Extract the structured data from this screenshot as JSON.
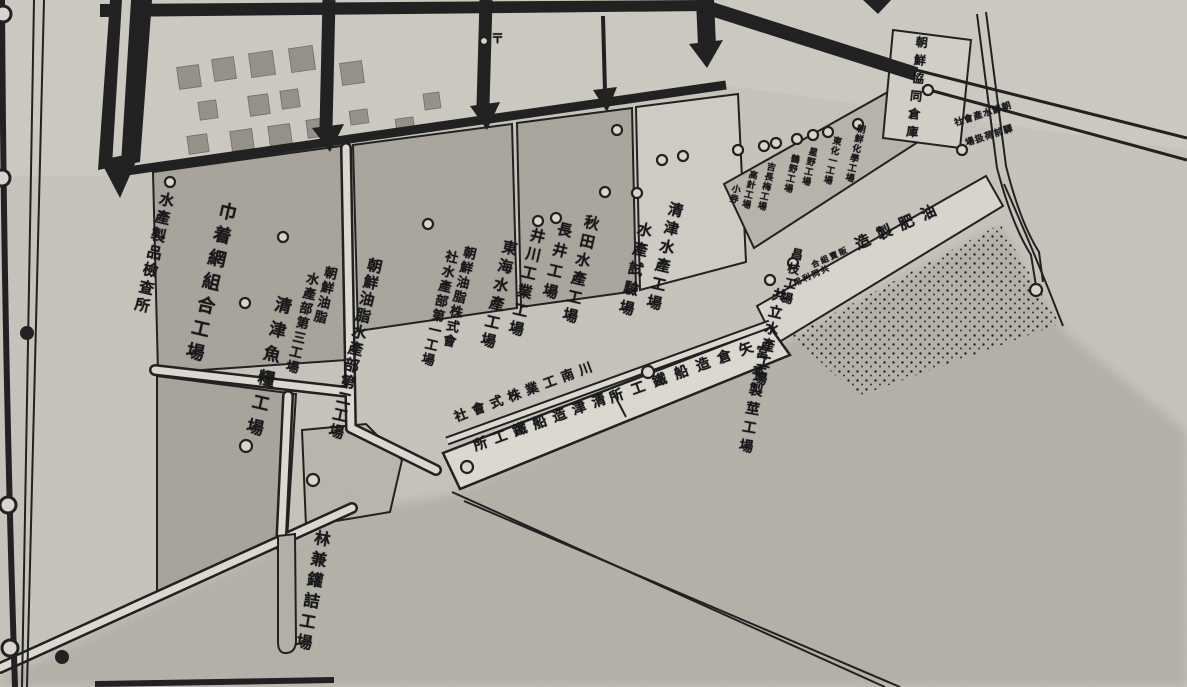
{
  "map_type": "historical-industrial-port-map",
  "colors": {
    "paper": "#c6c3bb",
    "paper_light": "#ccc9c1",
    "lot_dark": "#a7a39a",
    "lot_medium": "#b7b3aa",
    "lot_light": "#d2cfc7",
    "road_white": "#dcd9d1",
    "sea": "#b4b1a8",
    "ink": "#1c1c1c"
  },
  "symbols": {
    "post_mark": "〒",
    "ring_marker": "circle-outline",
    "dot_marker": "circle-filled"
  },
  "labels": [
    {
      "text": "水產製品檢查所"
    },
    {
      "text": "巾着網組合工場"
    },
    {
      "text": "清津魚糧工場"
    },
    {
      "text": "朝鮮油脂"
    },
    {
      "text": "水產部第三工場"
    },
    {
      "text": "朝鮮油脂水產部第二工場"
    },
    {
      "text": "朝鮮油脂株式會"
    },
    {
      "text": "社水產部第一工場"
    },
    {
      "text": "東海水產工場"
    },
    {
      "text": "井川工業工場"
    },
    {
      "text": "長井工場"
    },
    {
      "text": "秋田水產工場"
    },
    {
      "text": "水產試驗場"
    },
    {
      "text": "清津水產工場"
    },
    {
      "text": "小券"
    },
    {
      "text": "高針工場"
    },
    {
      "text": "吉長梅工場"
    },
    {
      "text": "鶴野工場"
    },
    {
      "text": "星野工場"
    },
    {
      "text": "東化一工場"
    },
    {
      "text": "朝鮮化學工場"
    },
    {
      "text": "朝鮮協同倉庫"
    },
    {
      "text": "社會產水鮮朝"
    },
    {
      "text": "場扱荷前驛"
    },
    {
      "text": "造製肥油"
    },
    {
      "text": "合組賣販"
    },
    {
      "text": "用利同共"
    },
    {
      "text": "昌枝工場"
    },
    {
      "text": "共立水產工場"
    },
    {
      "text": "宮本製莖工場"
    },
    {
      "text": "社會式株業工南川"
    },
    {
      "text": "所工鐵船造津清"
    },
    {
      "text": "所工鐵船造倉矢"
    },
    {
      "text": "林兼鑵詰工場"
    },
    {
      "text": "〒"
    }
  ]
}
